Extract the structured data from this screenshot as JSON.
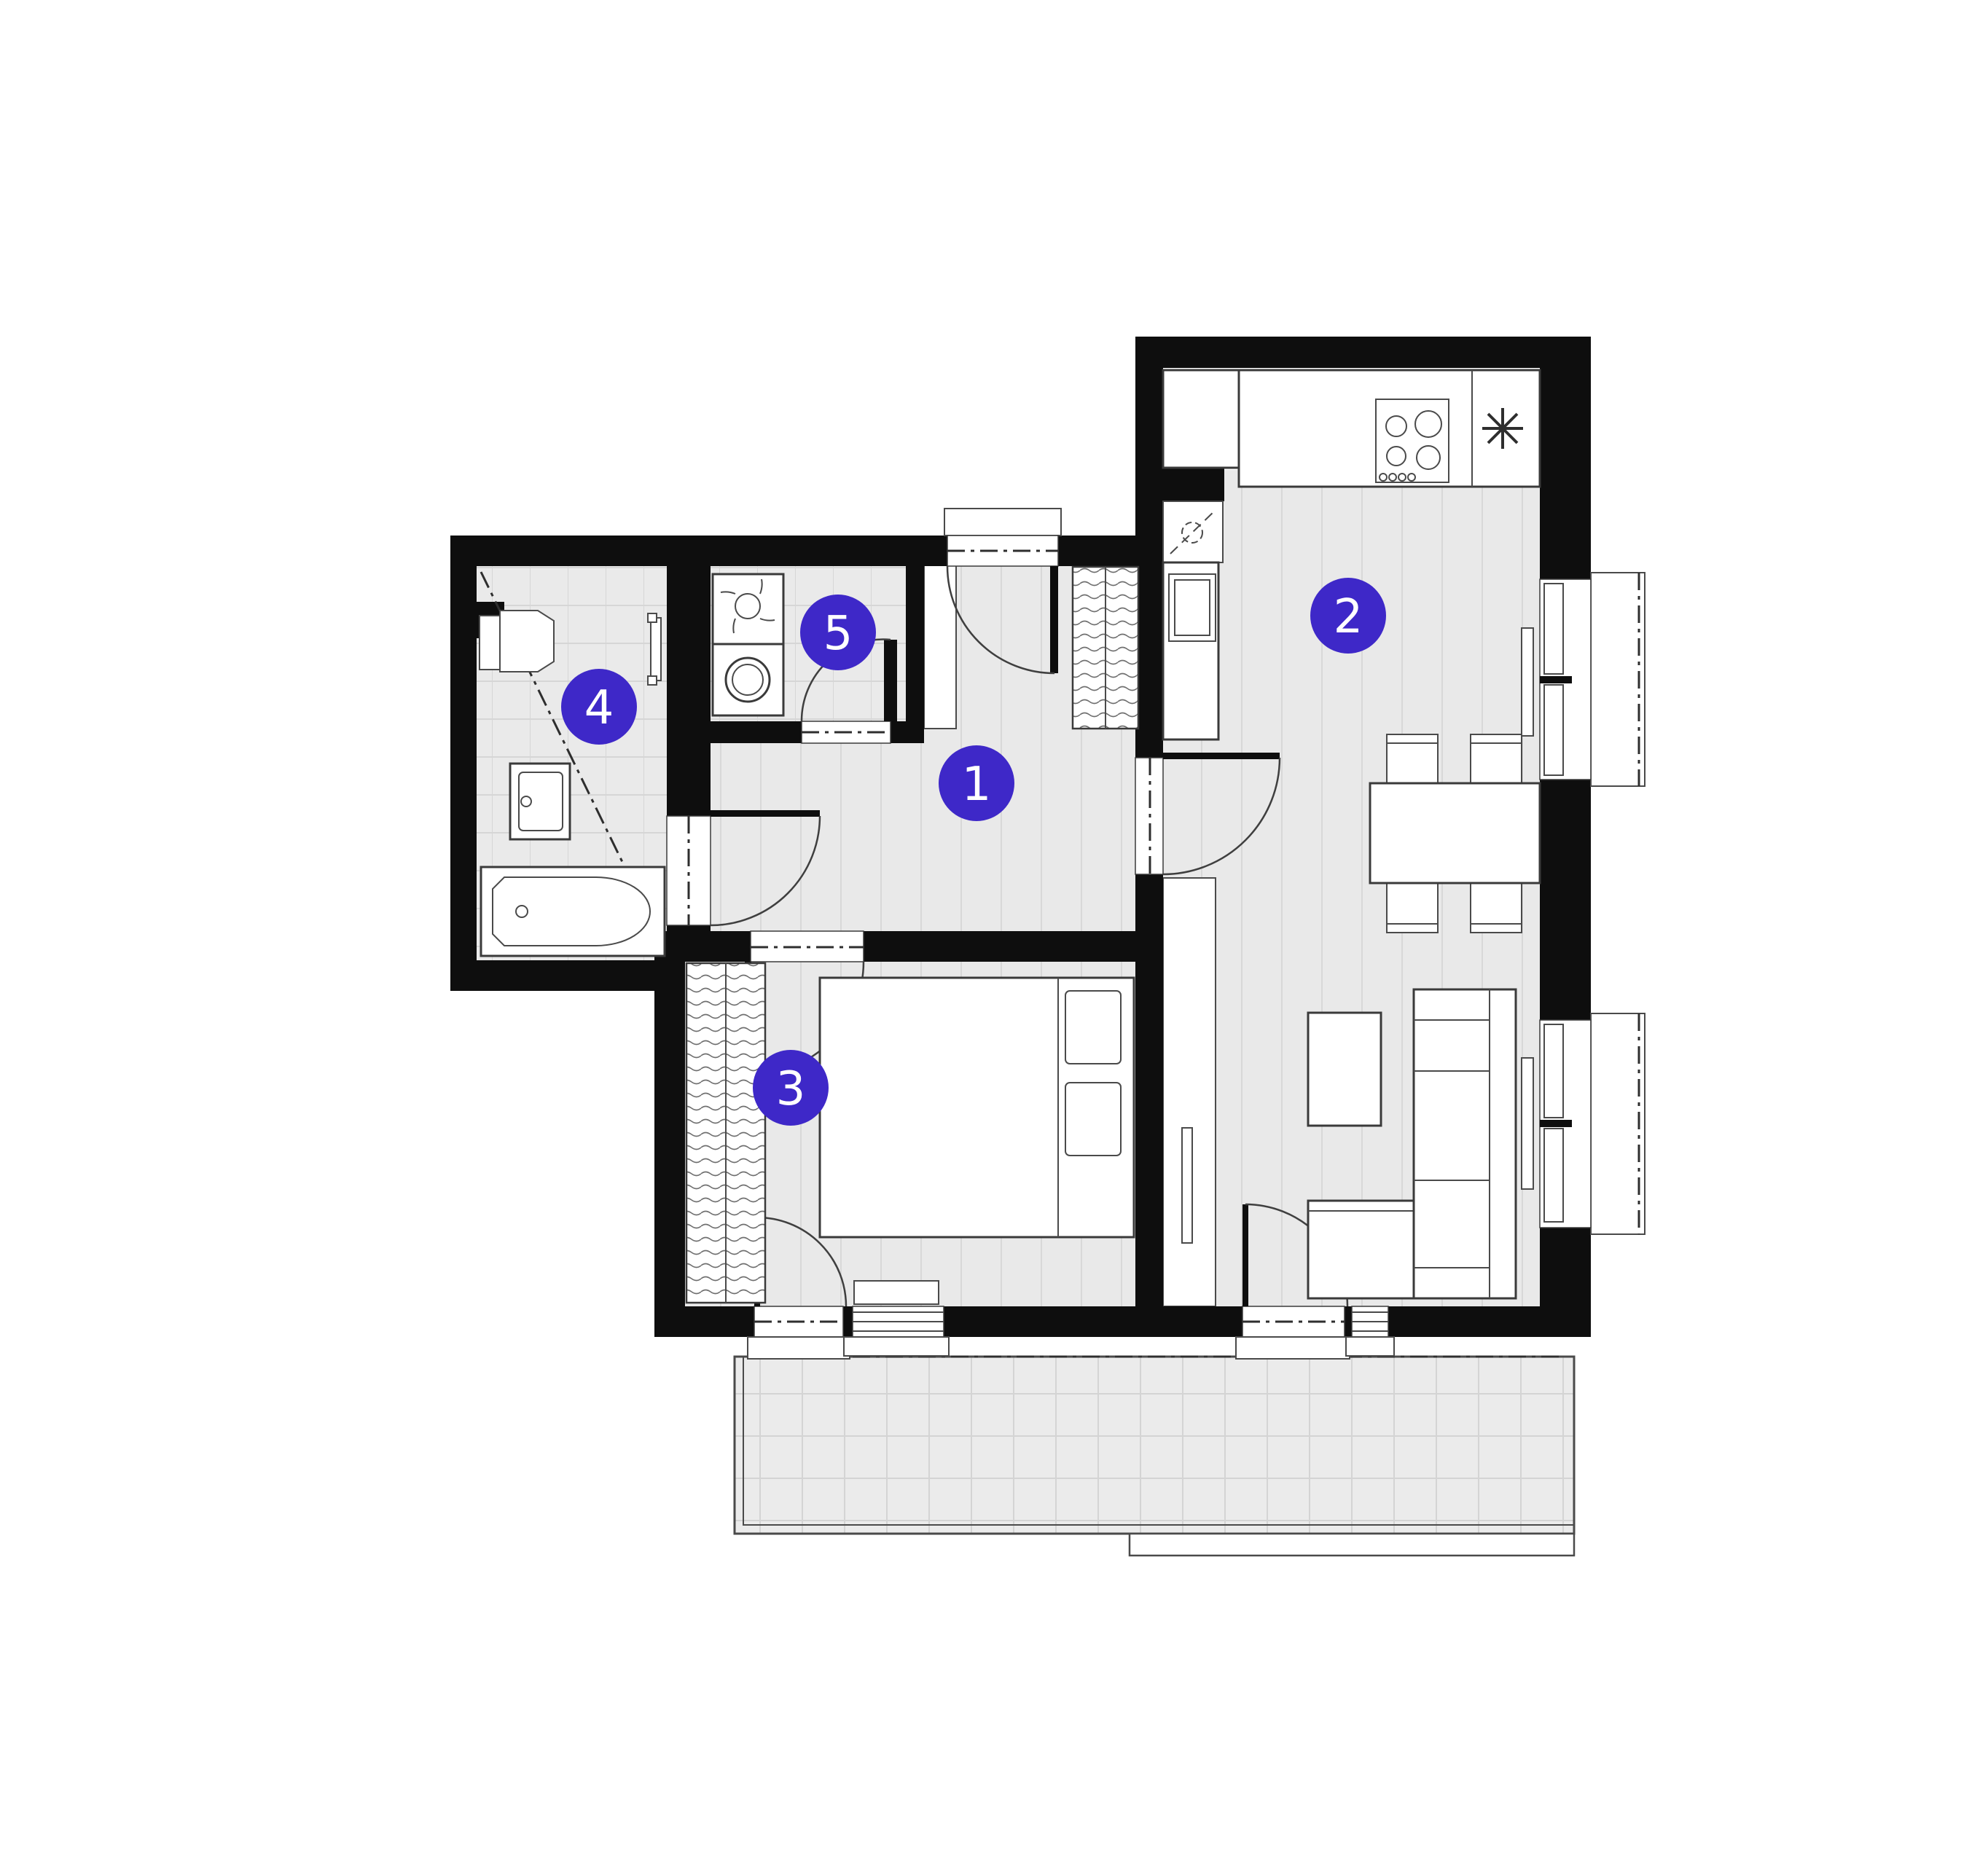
{
  "page": {
    "title": "apartment-floor-plan",
    "background": "#ffffff"
  },
  "plan": {
    "type": "2-room-apartment-floor-plan",
    "wall_color": "#0e0e0e",
    "floor_color": "#e9e9e9",
    "grid_line_color": "#d6d6d6",
    "fixture_line_color": "#3a3a3a",
    "marker_color": "#3e28c8",
    "marker_text_color": "#ffffff",
    "rooms": [
      {
        "number": "1",
        "name": "hallway"
      },
      {
        "number": "2",
        "name": "kitchen-living-room"
      },
      {
        "number": "3",
        "name": "bedroom"
      },
      {
        "number": "4",
        "name": "bathroom"
      },
      {
        "number": "5",
        "name": "laundry-room"
      }
    ],
    "fixtures": [
      "entrance-door",
      "hallway-wardrobe",
      "vent-shaft",
      "kitchen-sink",
      "kitchen-counter",
      "cooktop",
      "refrigerator-symbol",
      "dining-table",
      "dining-chairs",
      "coffee-table",
      "corner-sofa",
      "tv",
      "radiator",
      "bed",
      "bedroom-wardrobe",
      "toilet",
      "bathroom-sink",
      "bathtub",
      "towel-radiator",
      "shower-diagonal",
      "laundry-sink",
      "washing-machine",
      "balcony",
      "balcony-doors",
      "windows"
    ],
    "features": {
      "balcony": true,
      "windows_on_right_wall": 2,
      "entrance_side": "top"
    }
  }
}
